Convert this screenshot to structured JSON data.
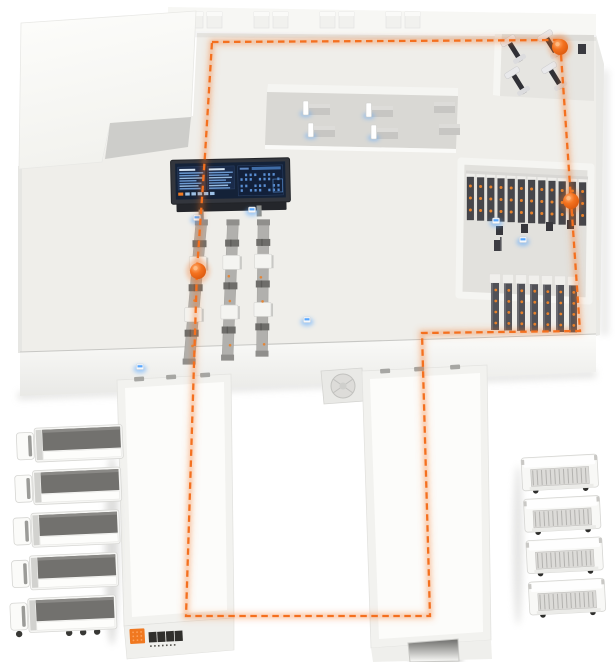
{
  "scene": {
    "name": "smart-warehouse-isometric-illustration",
    "background": "#ffffff",
    "accent_orange": "#f4701f",
    "sensor_blue": "#58a7ff"
  },
  "route": {
    "style": "dashed-loop",
    "color": "#f4701f",
    "points": [
      [
        212,
        42
      ],
      [
        560,
        40
      ],
      [
        571,
        200
      ],
      [
        580,
        331
      ],
      [
        422,
        333
      ],
      [
        430,
        616
      ],
      [
        186,
        616
      ],
      [
        197,
        270
      ],
      [
        205,
        155
      ]
    ],
    "marker_points": [
      [
        560,
        47
      ],
      [
        571,
        201
      ],
      [
        198,
        271
      ]
    ],
    "marker_color": "#ee6414"
  },
  "building": {
    "floor_color": "#efeeea",
    "workstation_bay_color": "#d9d8d4",
    "racking_bay_color": "#e2e1dd",
    "machine_bay_color": "#e6e5e1",
    "roof_color": "#fbfbf9",
    "band_color": "#f7f7f4",
    "wall_shade_color": "#cdcdca",
    "skylight_pairs": 4
  },
  "dashboard": {
    "frame_color": "#33363d",
    "screen_color": "#142238",
    "panel_color": "#1a2b4a",
    "line_color": "#6f9fd8",
    "light_line_color": "#9cc2e8",
    "header_color": "#d6e5f4",
    "title_bar_color": "#3f6ca6",
    "dot_color": "#5a8ed2",
    "accent_chip_color": "#f07a22",
    "left_panels": 2,
    "lines_per_panel": 7,
    "chips": 6
  },
  "conveyors": {
    "count": 3,
    "belt_color": "#b1b0ad",
    "station_color": "#f4f4f1",
    "roller_color": "#6e6d6a",
    "item_color": "#e8822c"
  },
  "racking": {
    "back_row_units": 12,
    "front_row_units": 7,
    "unit_color": "#46464b",
    "front_unit_color": "#515157",
    "cap_color": "#efeeeb",
    "box_color": "#e8822c",
    "device_boxes": 4
  },
  "workstations": {
    "count": 4,
    "extra_desks": 2,
    "monitor_color": "#ffffff",
    "desk_color": "#c7c6c3"
  },
  "dock_machines": {
    "count": 4
  },
  "sensors": {
    "positions": [
      [
        140,
        367
      ],
      [
        197,
        218
      ],
      [
        252,
        210
      ],
      [
        307,
        320
      ],
      [
        496,
        221
      ],
      [
        523,
        240
      ]
    ]
  },
  "fleet": {
    "left": {
      "count": 5,
      "type": "semi-truck",
      "body_color": "#f6f6f4",
      "top_color": "#72716e"
    },
    "right": {
      "count": 4,
      "type": "box-truck",
      "body_color": "#f8f8f6",
      "shutter_color": "#dcdbd8"
    }
  },
  "logo": {
    "mark_color": "#f07820",
    "text": "▇▇▇▇",
    "subtext": "▪ ▪ ▪ ▪ ▪ ▪ ▪",
    "text_color": "#302f2c"
  }
}
